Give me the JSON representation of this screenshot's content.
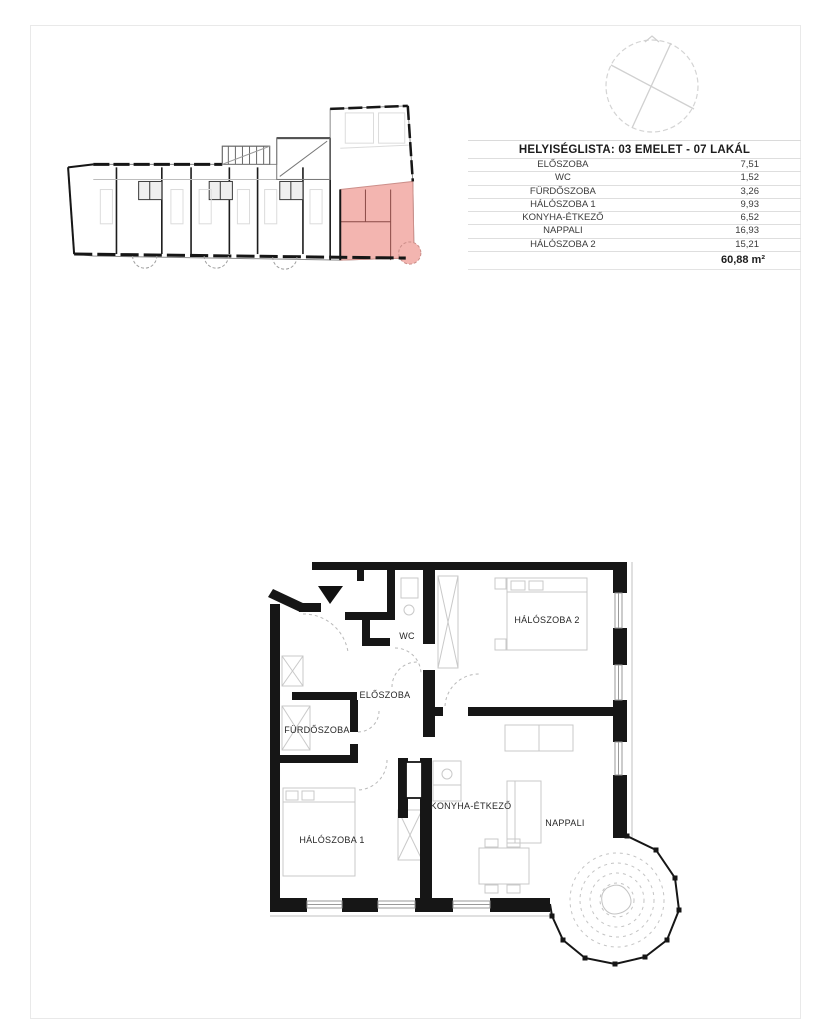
{
  "page": {
    "background": "#ffffff",
    "frame_color": "#e9e9e9"
  },
  "room_table": {
    "title": "HELYISÉGLISTA: 03 EMELET - 07 LAKÁL",
    "rows": [
      {
        "name": "ELŐSZOBA",
        "area": "7,51"
      },
      {
        "name": "WC",
        "area": "1,52"
      },
      {
        "name": "FÜRDŐSZOBA",
        "area": "3,26"
      },
      {
        "name": "HÁLÓSZOBA 1",
        "area": "9,93"
      },
      {
        "name": "KONYHA-ÉTKEZŐ",
        "area": "6,52"
      },
      {
        "name": "NAPPALI",
        "area": "16,93"
      },
      {
        "name": "HÁLÓSZOBA 2",
        "area": "15,21"
      }
    ],
    "total_area": "60,88 m²"
  },
  "overview_plan": {
    "highlight_color": "#f3b5b0",
    "highlight_stroke": "#cc8f8a"
  },
  "compass": {
    "stroke": "#d4d4d4"
  },
  "main_plan": {
    "wall_color": "#161616",
    "labels": {
      "wc": "WC",
      "eloszoba": "ELŐSZOBA",
      "furdoszoba": "FÜRDŐSZOBA",
      "haloszoba1": "HÁLÓSZOBA 1",
      "haloszoba2": "HÁLÓSZOBA 2",
      "konyha_etkezo": "KONYHA-ÉTKEZŐ",
      "nappali": "NAPPALI"
    }
  }
}
